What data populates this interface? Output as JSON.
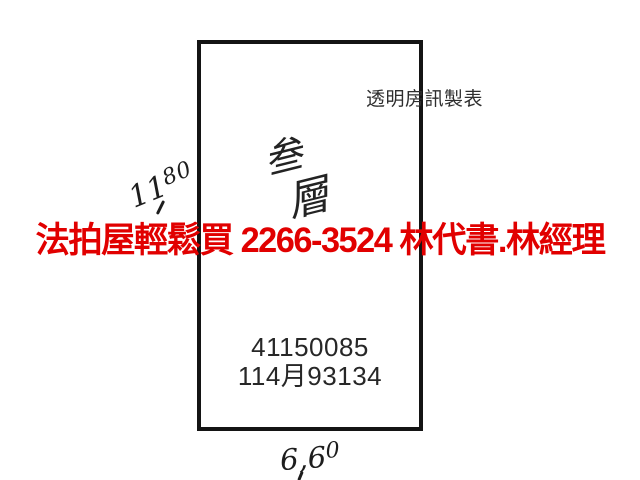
{
  "ad_overlay": {
    "text": "法拍屋輕鬆買  2266-3524  林代書.林經理",
    "color": "#e10000"
  },
  "sketch": {
    "maker_label": "透明房訊製表",
    "floor_note": {
      "char_1": "叁",
      "char_2": "層"
    },
    "dimension_top": {
      "main": "11",
      "sup": "80"
    },
    "dimension_bottom": {
      "main": "6,6",
      "sup": "0"
    },
    "case_number": "41150085",
    "date_code": "114月93134",
    "outline_color": "#141414",
    "ink_color": "#1d1d1d"
  }
}
